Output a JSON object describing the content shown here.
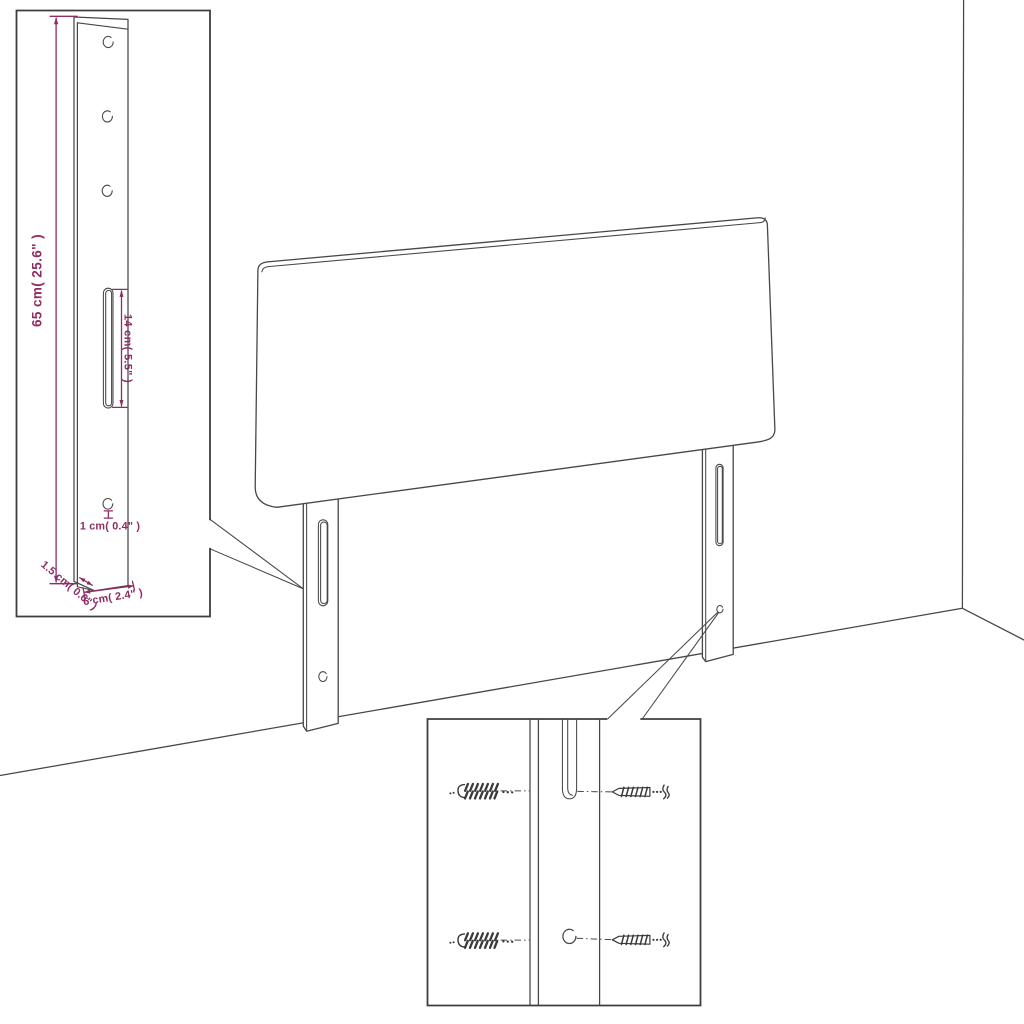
{
  "diagram": {
    "type": "furniture-assembly-instruction",
    "product": "headboard with mounting legs",
    "background_color": "#ffffff",
    "line_color": "#474747",
    "dimension_color": "#8e2c63",
    "leg_detail_inset": {
      "labels": {
        "leg_height": "65 cm( 25.6\" )",
        "slot_length": "14 cm( 5.5\" )",
        "hole_size": "1 cm( 0.4\" )",
        "leg_thickness": "1.5 cm( 0.6\" )",
        "leg_width": "6 cm( 2.4\" )"
      },
      "round_holes": 4,
      "slots": 1
    },
    "hardware_detail_inset": {
      "wall_anchors": 2,
      "screws": 2,
      "round_holes": 1,
      "slots": 1
    },
    "main_scene": {
      "legs": 2,
      "slots_per_leg": 1,
      "holes_per_leg": 1
    }
  }
}
